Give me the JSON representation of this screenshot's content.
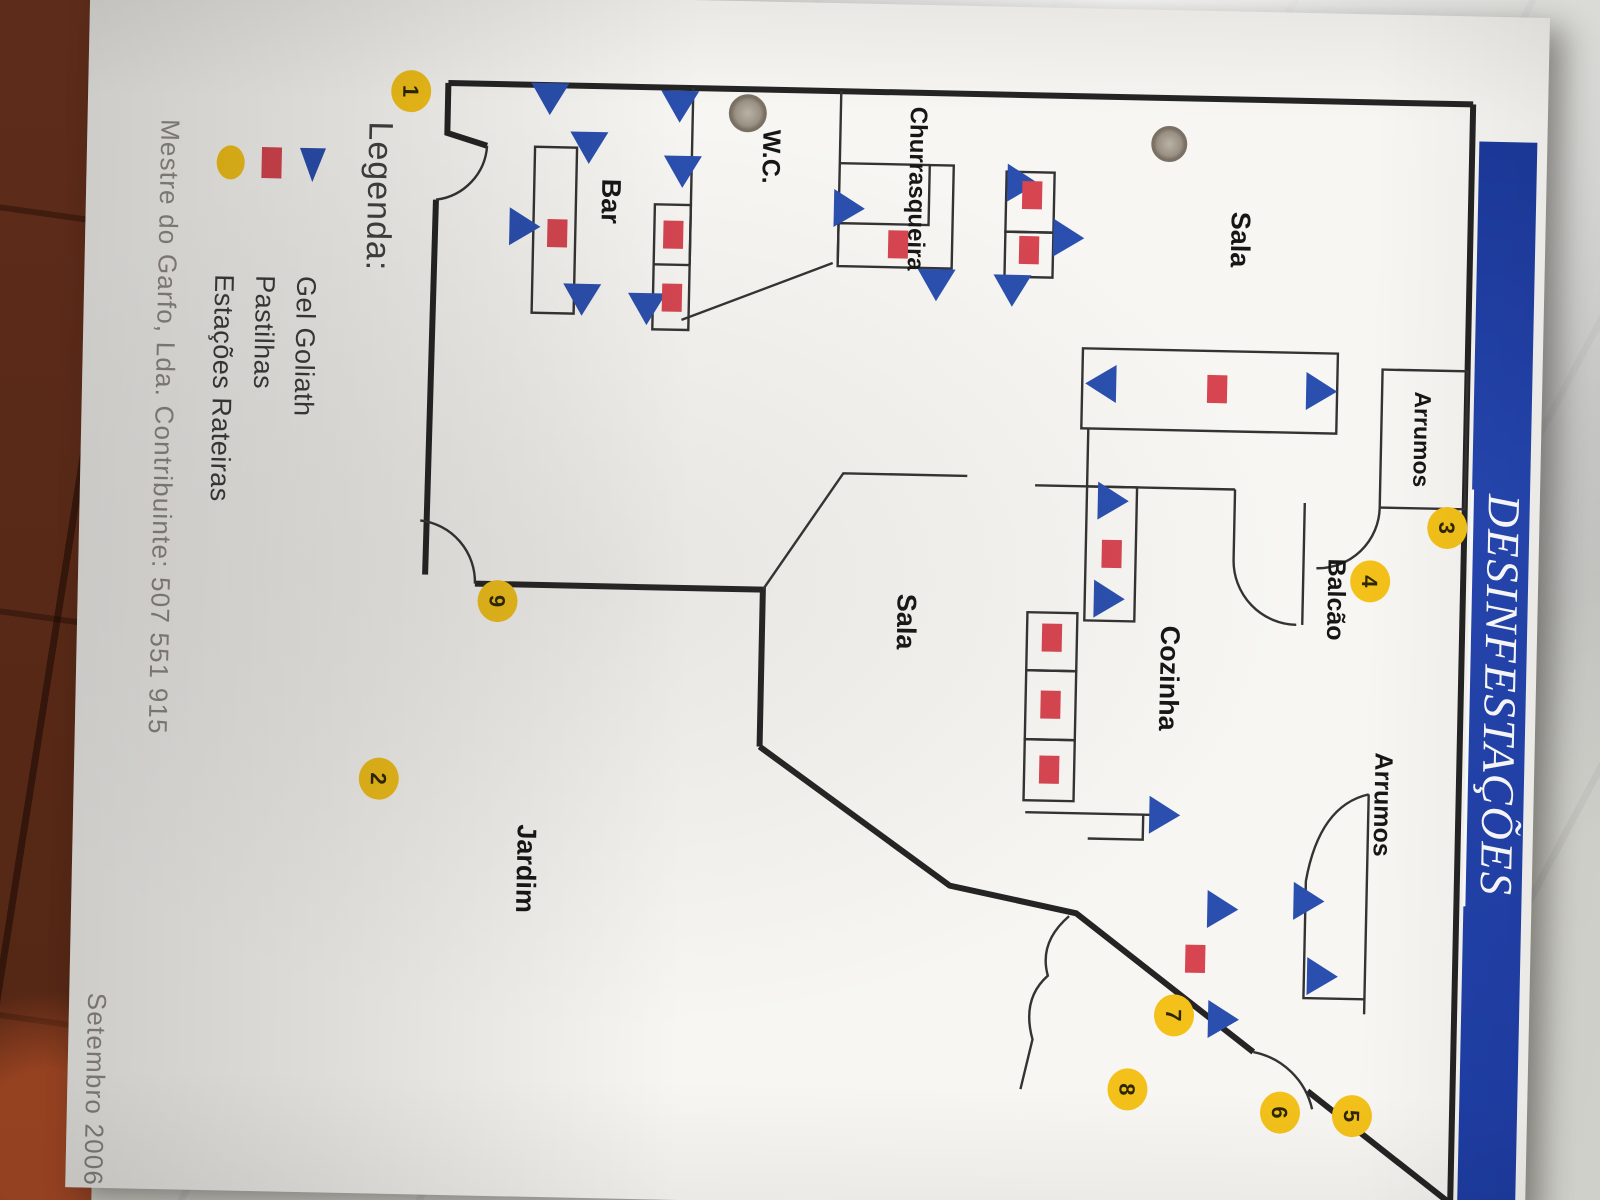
{
  "document": {
    "title": "DESINFESTAÇÕES",
    "legend": {
      "heading": "Legenda:",
      "items": [
        {
          "symbol": "blue-triangle",
          "label": "Gel Goliath"
        },
        {
          "symbol": "red-square",
          "label": "Pastilhas"
        },
        {
          "symbol": "yellow-circle",
          "label": "Estações Rateiras"
        }
      ]
    },
    "footer": {
      "company": "Mestre do Garfo, Lda. Contribuinte: 507 551 915",
      "date": "Setembro 2006"
    },
    "colors": {
      "banner_blue": "#2042a8",
      "triangle_blue": "#2a4fae",
      "square_red": "#d64550",
      "station_yellow": "#f3c119",
      "wall_black": "#242424"
    },
    "plan": {
      "rooms": [
        {
          "id": "sala-1",
          "label": "Sala",
          "x": 228,
          "y": 314,
          "fs": 27
        },
        {
          "id": "arrumos-top",
          "label": "Arrumos",
          "x": 424,
          "y": 127,
          "fs": 23
        },
        {
          "id": "balcao",
          "label": "Balcão",
          "x": 586,
          "y": 210,
          "fs": 25
        },
        {
          "id": "cozinha",
          "label": "Cozinha",
          "x": 668,
          "y": 376,
          "fs": 27
        },
        {
          "id": "sala-2",
          "label": "Sala",
          "x": 617,
          "y": 640,
          "fs": 27
        },
        {
          "id": "arrumos-right",
          "label": "Arrumos",
          "x": 790,
          "y": 159,
          "fs": 25
        },
        {
          "id": "churrasqueira",
          "label": "Churrasqueira",
          "x": 184,
          "y": 637,
          "fs": 24
        },
        {
          "id": "wc",
          "label": "W.C.",
          "x": 155,
          "y": 784,
          "fs": 25
        },
        {
          "id": "bar",
          "label": "Bar",
          "x": 203,
          "y": 944,
          "fs": 27
        },
        {
          "id": "jardim",
          "label": "Jardim",
          "x": 872,
          "y": 1015,
          "fs": 27
        }
      ],
      "gel_goliath_points": [
        {
          "x": 176,
          "y": 525,
          "d": "up"
        },
        {
          "x": 230,
          "y": 478,
          "d": "up"
        },
        {
          "x": 282,
          "y": 532,
          "d": "right"
        },
        {
          "x": 205,
          "y": 698,
          "d": "up"
        },
        {
          "x": 278,
          "y": 608,
          "d": "right"
        },
        {
          "x": 100,
          "y": 998,
          "d": "right"
        },
        {
          "x": 148,
          "y": 958,
          "d": "right"
        },
        {
          "x": 105,
          "y": 868,
          "d": "right"
        },
        {
          "x": 170,
          "y": 864,
          "d": "right"
        },
        {
          "x": 300,
          "y": 962,
          "d": "right"
        },
        {
          "x": 308,
          "y": 897,
          "d": "right"
        },
        {
          "x": 230,
          "y": 1022,
          "d": "up"
        },
        {
          "x": 378,
          "y": 222,
          "d": "up"
        },
        {
          "x": 375,
          "y": 440,
          "d": "down"
        },
        {
          "x": 492,
          "y": 428,
          "d": "up"
        },
        {
          "x": 590,
          "y": 430,
          "d": "up"
        },
        {
          "x": 805,
          "y": 370,
          "d": "up"
        },
        {
          "x": 898,
          "y": 310,
          "d": "up"
        },
        {
          "x": 1008,
          "y": 307,
          "d": "up"
        },
        {
          "x": 888,
          "y": 224,
          "d": "up"
        },
        {
          "x": 963,
          "y": 209,
          "d": "up"
        }
      ],
      "pastilhas_points": [
        {
          "x": 188,
          "y": 514
        },
        {
          "x": 243,
          "y": 516
        },
        {
          "x": 235,
          "y": 872
        },
        {
          "x": 298,
          "y": 872
        },
        {
          "x": 236,
          "y": 988
        },
        {
          "x": 240,
          "y": 647
        },
        {
          "x": 378,
          "y": 325
        },
        {
          "x": 545,
          "y": 427
        },
        {
          "x": 630,
          "y": 485
        },
        {
          "x": 697,
          "y": 485
        },
        {
          "x": 762,
          "y": 485
        },
        {
          "x": 948,
          "y": 335
        }
      ],
      "estacoes_rateiras": [
        {
          "n": "1",
          "x": 97,
          "y": 1137
        },
        {
          "n": "2",
          "x": 785,
          "y": 1155
        },
        {
          "n": "3",
          "x": 512,
          "y": 92
        },
        {
          "n": "4",
          "x": 567,
          "y": 168
        },
        {
          "n": "5",
          "x": 1102,
          "y": 175
        },
        {
          "n": "6",
          "x": 1100,
          "y": 247
        },
        {
          "n": "7",
          "x": 1005,
          "y": 355
        },
        {
          "n": "8",
          "x": 1080,
          "y": 400
        },
        {
          "n": "9",
          "x": 605,
          "y": 1040
        }
      ]
    }
  }
}
